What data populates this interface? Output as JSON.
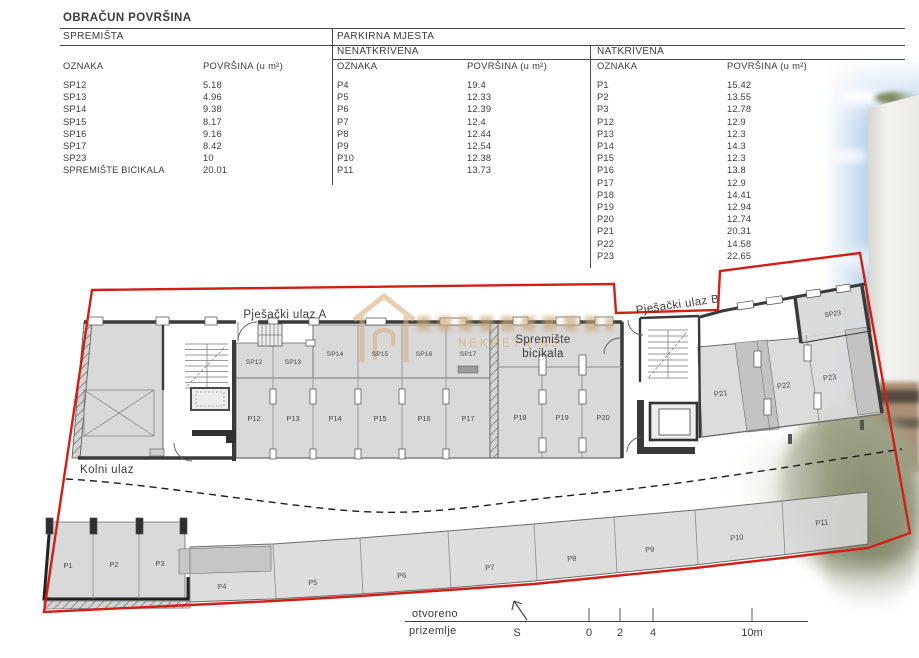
{
  "title": "OBRAČUN POVRŠINA",
  "tables": {
    "spremista": {
      "header": "SPREMIŠTA",
      "col_oznaka": "OZNAKA",
      "col_povrsina": "POVRŠINA (u m²)",
      "rows": [
        {
          "oznaka": "SP12",
          "povrsina": "5.18"
        },
        {
          "oznaka": "SP13",
          "povrsina": "4.96"
        },
        {
          "oznaka": "SP14",
          "povrsina": "9.38"
        },
        {
          "oznaka": "SP15",
          "povrsina": "8.17"
        },
        {
          "oznaka": "SP16",
          "povrsina": "9.16"
        },
        {
          "oznaka": "SP17",
          "povrsina": "8.42"
        },
        {
          "oznaka": "SP23",
          "povrsina": "10"
        },
        {
          "oznaka": "SPREMIŠTE BICIKALA",
          "povrsina": "20.01"
        }
      ]
    },
    "parkirna_header": "PARKIRNA MJESTA",
    "nenatkrivena": {
      "header": "NENATKRIVENA",
      "col_oznaka": "OZNAKA",
      "col_povrsina": "POVRŠINA (u m²)",
      "rows": [
        {
          "oznaka": "P4",
          "povrsina": "19.4"
        },
        {
          "oznaka": "P5",
          "povrsina": "12.33"
        },
        {
          "oznaka": "P6",
          "povrsina": "12.39"
        },
        {
          "oznaka": "P7",
          "povrsina": "12.4"
        },
        {
          "oznaka": "P8",
          "povrsina": "12.44"
        },
        {
          "oznaka": "P9",
          "povrsina": "12.54"
        },
        {
          "oznaka": "P10",
          "povrsina": "12.38"
        },
        {
          "oznaka": "P11",
          "povrsina": "13.73"
        }
      ]
    },
    "natkrivena": {
      "header": "NATKRIVENA",
      "col_oznaka": "OZNAKA",
      "col_povrsina": "POVRŠINA (u m²)",
      "rows": [
        {
          "oznaka": "P1",
          "povrsina": "15.42"
        },
        {
          "oznaka": "P2",
          "povrsina": "13.55"
        },
        {
          "oznaka": "P3",
          "povrsina": "12.78"
        },
        {
          "oznaka": "P12",
          "povrsina": "12.9"
        },
        {
          "oznaka": "P13",
          "povrsina": "12.3"
        },
        {
          "oznaka": "P14",
          "povrsina": "14.3"
        },
        {
          "oznaka": "P15",
          "povrsina": "12.3"
        },
        {
          "oznaka": "P16",
          "povrsina": "13.8"
        },
        {
          "oznaka": "P17",
          "povrsina": "12.9"
        },
        {
          "oznaka": "P18",
          "povrsina": "14.41"
        },
        {
          "oznaka": "P19",
          "povrsina": "12.94"
        },
        {
          "oznaka": "P20",
          "povrsina": "12.74"
        },
        {
          "oznaka": "P21",
          "povrsina": "20.31"
        },
        {
          "oznaka": "P22",
          "povrsina": "14.58"
        },
        {
          "oznaka": "P23",
          "povrsina": "22.65"
        }
      ]
    }
  },
  "plan": {
    "entrance_a": "Pješački ulaz A",
    "entrance_b": "Pješački ulaz B",
    "kolni_ulaz": "Kolni ulaz",
    "bike_storage_line1": "Spremište",
    "bike_storage_line2": "bicikala",
    "storage_labels": [
      "SP12",
      "SP13",
      "SP14",
      "SP15",
      "SP16",
      "SP17"
    ],
    "storage_right": "SP23",
    "parking_labels_main": [
      "P12",
      "P13",
      "P14",
      "P15",
      "P16",
      "P17",
      "P18",
      "P19",
      "P20"
    ],
    "parking_labels_right": [
      "P21",
      "P22",
      "P23"
    ],
    "parking_labels_bottom": [
      "P1",
      "P2",
      "P3",
      "P4",
      "P5",
      "P6",
      "P7",
      "P8",
      "P9",
      "P10",
      "P11"
    ]
  },
  "legend": {
    "line1": "otvoreno",
    "line2": "prizemlje",
    "north": "S",
    "scale_ticks": [
      "0",
      "2",
      "4",
      "10m"
    ]
  },
  "watermark": {
    "text": "NEKRETNINE"
  },
  "colors": {
    "boundary_red": "#d11f18",
    "plan_gray": "#d9d9d9",
    "plan_dark": "#3a3a3a",
    "watermark_orange": "#e09b3a"
  }
}
